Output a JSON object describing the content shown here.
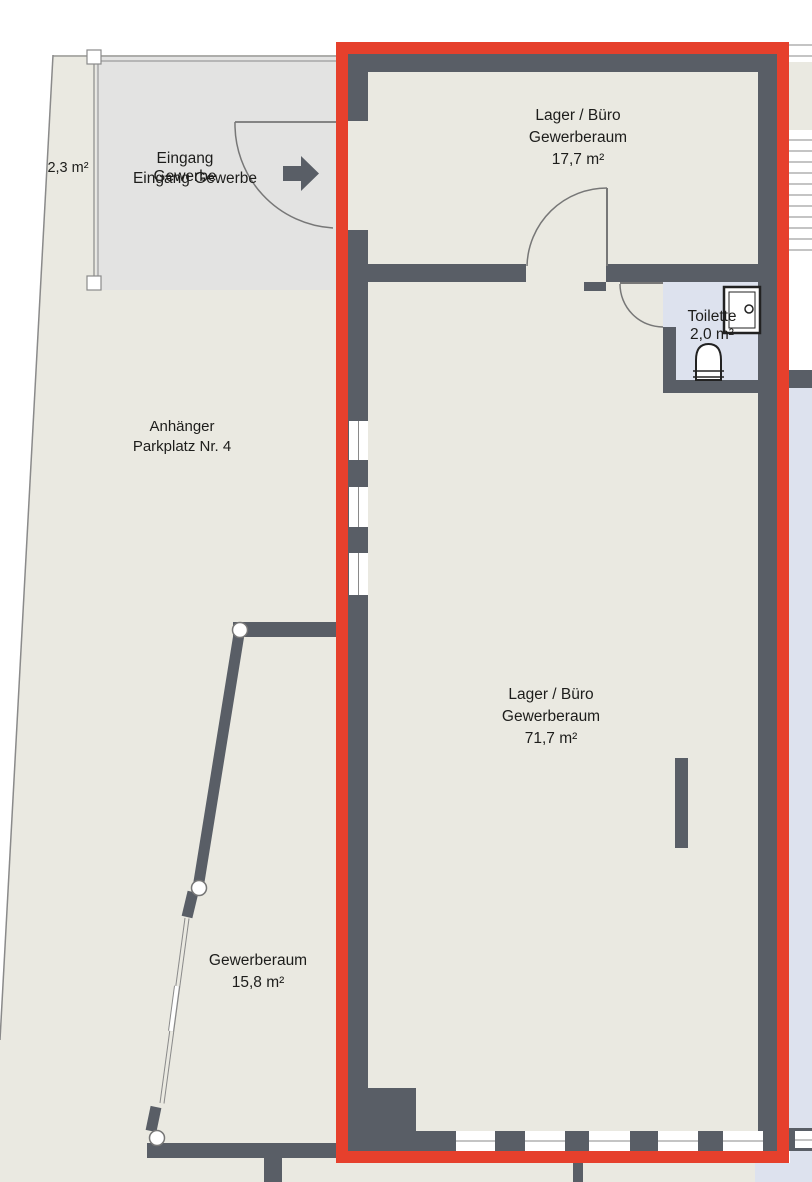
{
  "colors": {
    "wall": "#595e66",
    "red": "#e6402c",
    "parcel": "#eae9e1",
    "entrance": "#e3e3e2",
    "blue": "#dde2ee",
    "line": "#8a8a8a",
    "door": "#777777",
    "text": "#1d1d1b",
    "window": "#ffffff"
  },
  "labels": {
    "small_area": "2,3 m²",
    "entrance_stacked": {
      "l1": "Eingang",
      "l2": "Gewerbe"
    },
    "entrance_overlay": "Eingang Gewerbe",
    "room_top": {
      "l1": "Lager / Büro",
      "l2": "Gewerberaum",
      "l3": "17,7 m²"
    },
    "toilet": {
      "l1": "Toilette",
      "l2": "2,0 m²"
    },
    "parking": {
      "l1": "Anhänger",
      "l2": "Parkplatz Nr. 4"
    },
    "room_main": {
      "l1": "Lager / Büro",
      "l2": "Gewerberaum",
      "l3": "71,7 m²"
    },
    "room_small": {
      "l1": "Gewerberaum",
      "l2": "15,8 m²"
    }
  },
  "icons": {
    "entrance_arrow": "arrow-right",
    "sink": "washbasin",
    "wc": "toilet-bowl",
    "posts": "wall-post-marker"
  }
}
